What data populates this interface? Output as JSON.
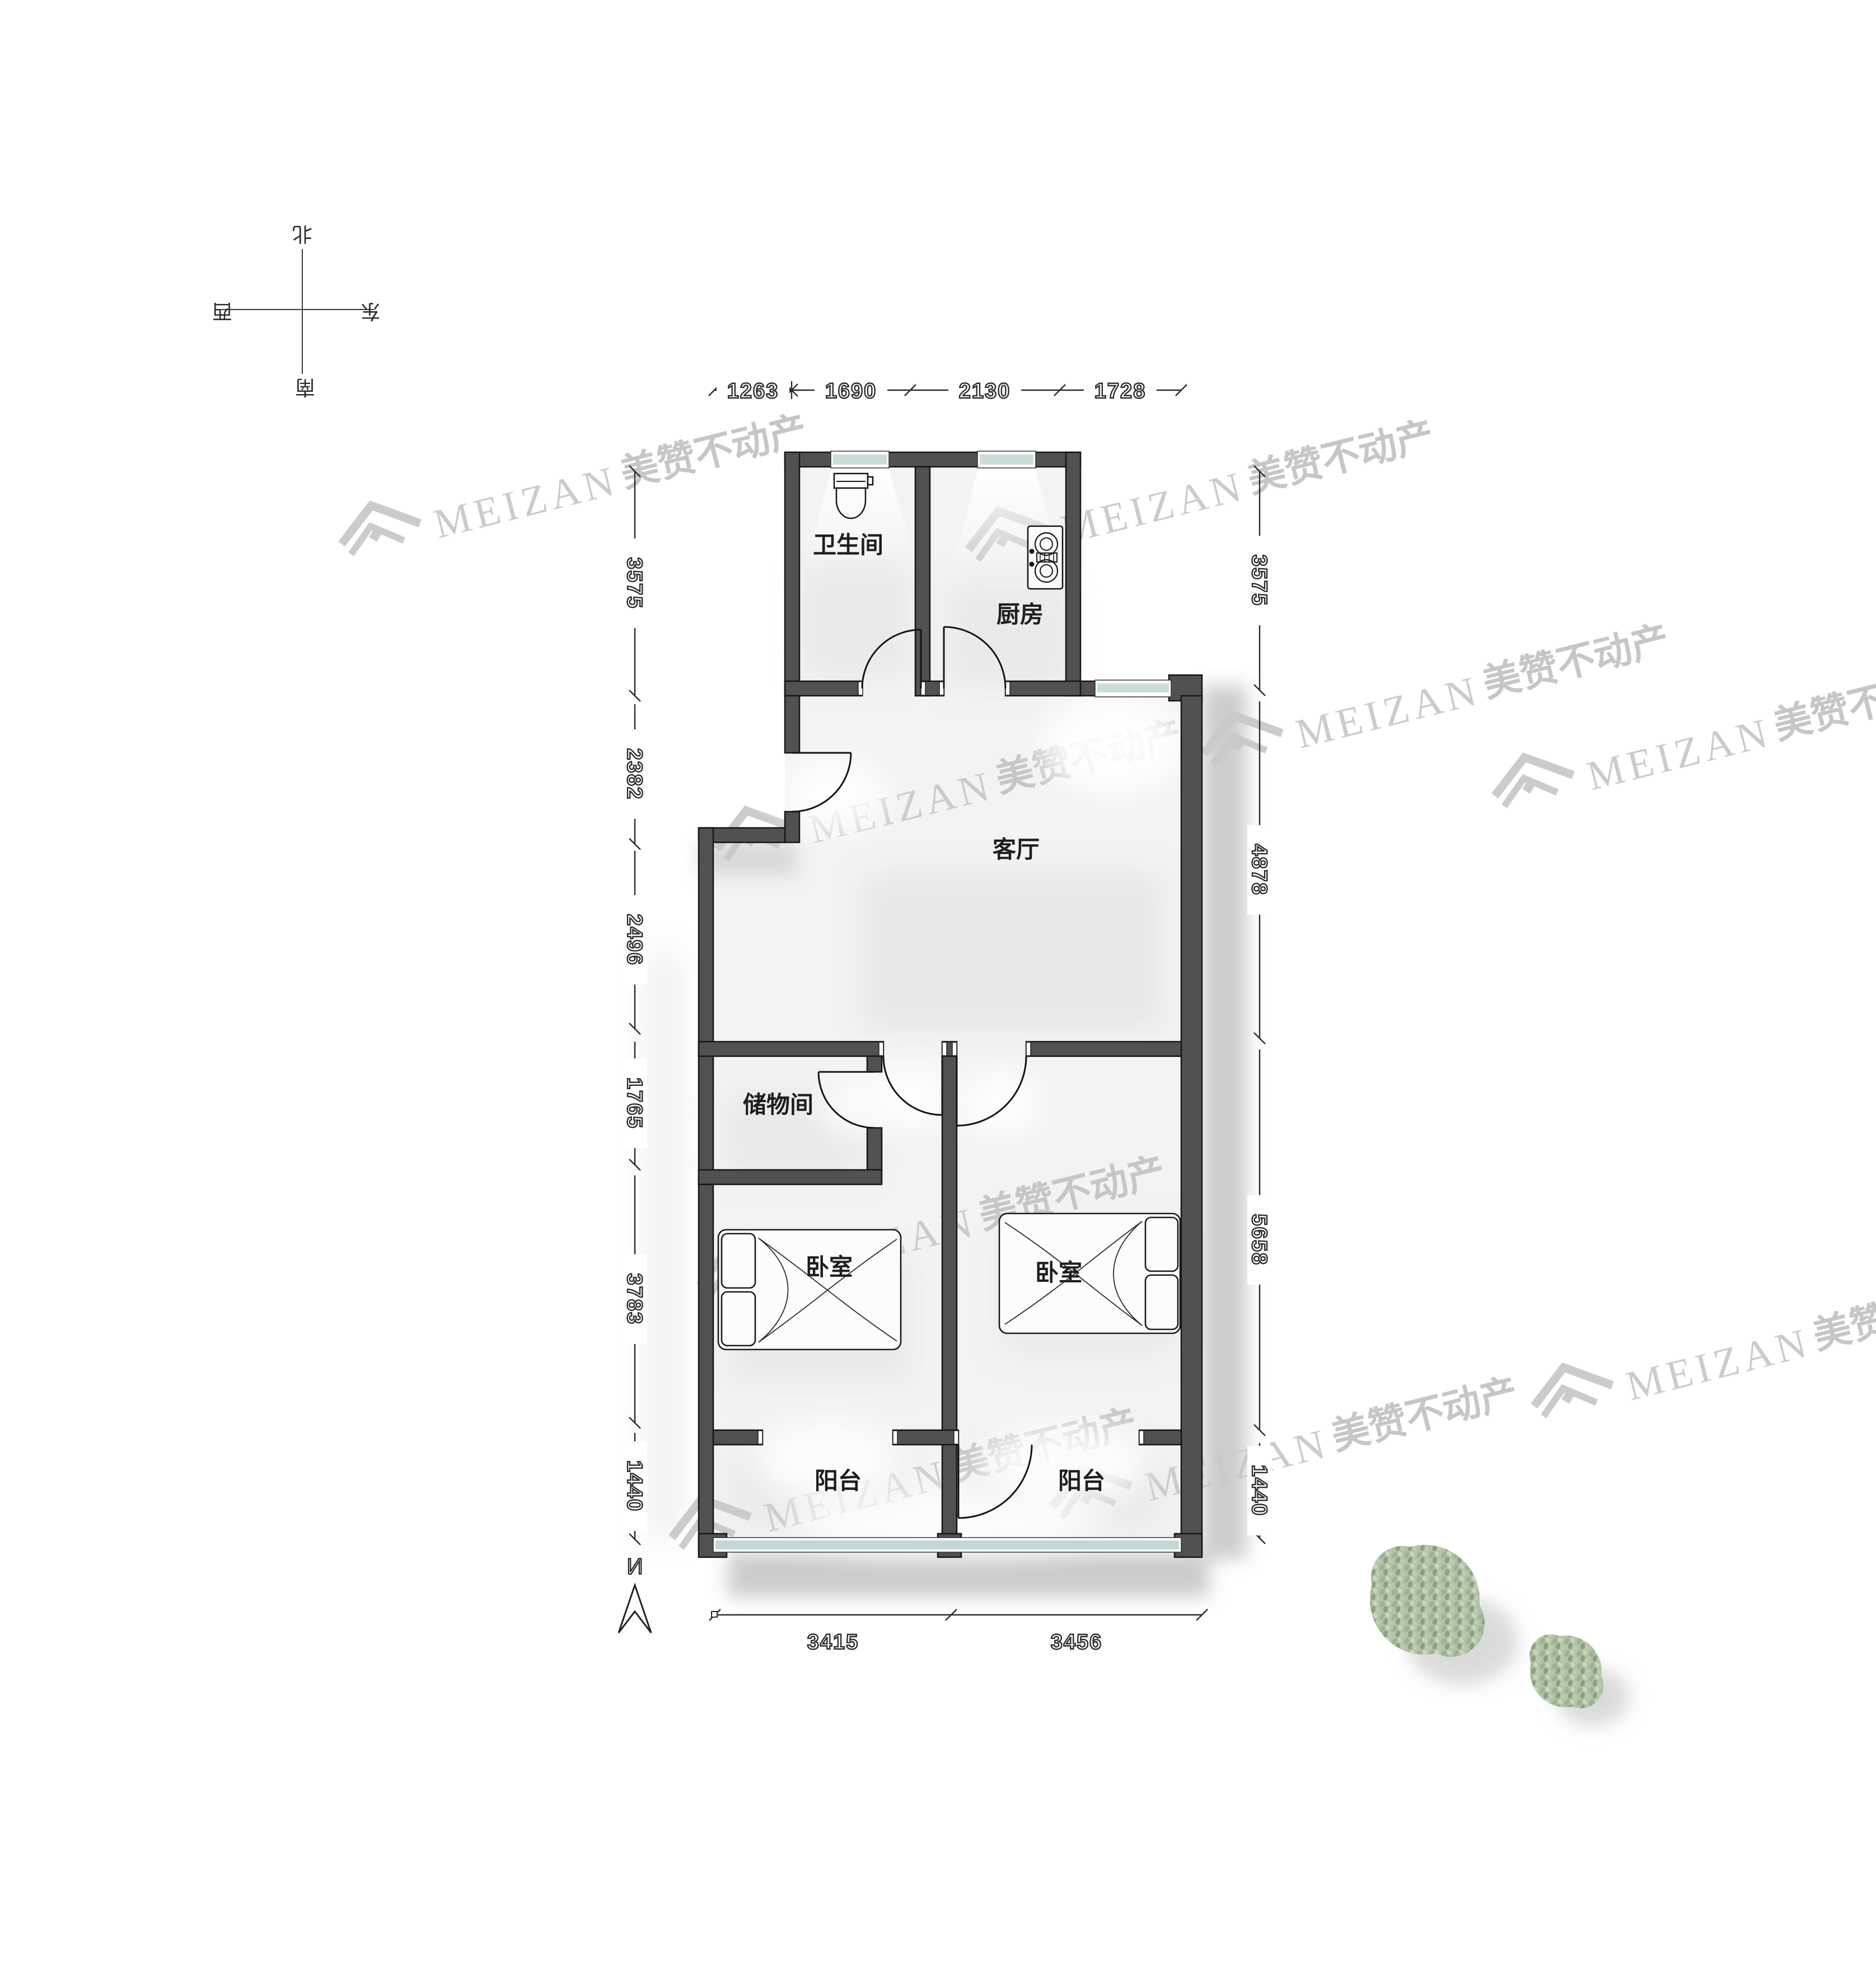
{
  "plan": {
    "title": "apartment-floor-plan",
    "rooms": {
      "bathroom": "卫生间",
      "kitchen": "厨房",
      "living": "客厅",
      "storage": "储物间",
      "bedroom_left": "卧室",
      "bedroom_right": "卧室",
      "balcony_left": "阳台",
      "balcony_right": "阳台"
    },
    "dimensions": {
      "top": [
        "1263",
        "1690",
        "2130",
        "1728"
      ],
      "left": [
        "3575",
        "2382",
        "2496",
        "1765",
        "3783",
        "1440"
      ],
      "right": [
        "3575",
        "4878",
        "5658",
        "1440"
      ],
      "bottom": [
        "3415",
        "3456"
      ]
    },
    "compass": {
      "north": "北",
      "south": "南",
      "west": "西",
      "east": "东"
    },
    "north_indicator": "N",
    "watermark": {
      "brand_en": "MEIZAN",
      "brand_zh": "美赞不动产"
    },
    "colors": {
      "wall": "#515153",
      "window_glass": "#c9dedb",
      "tree_foliage": "#b2c3a8",
      "watermark_gray": "#c7c7c7",
      "dim_ink": "#2c2c2c",
      "floor": "#f3f3f3"
    }
  }
}
